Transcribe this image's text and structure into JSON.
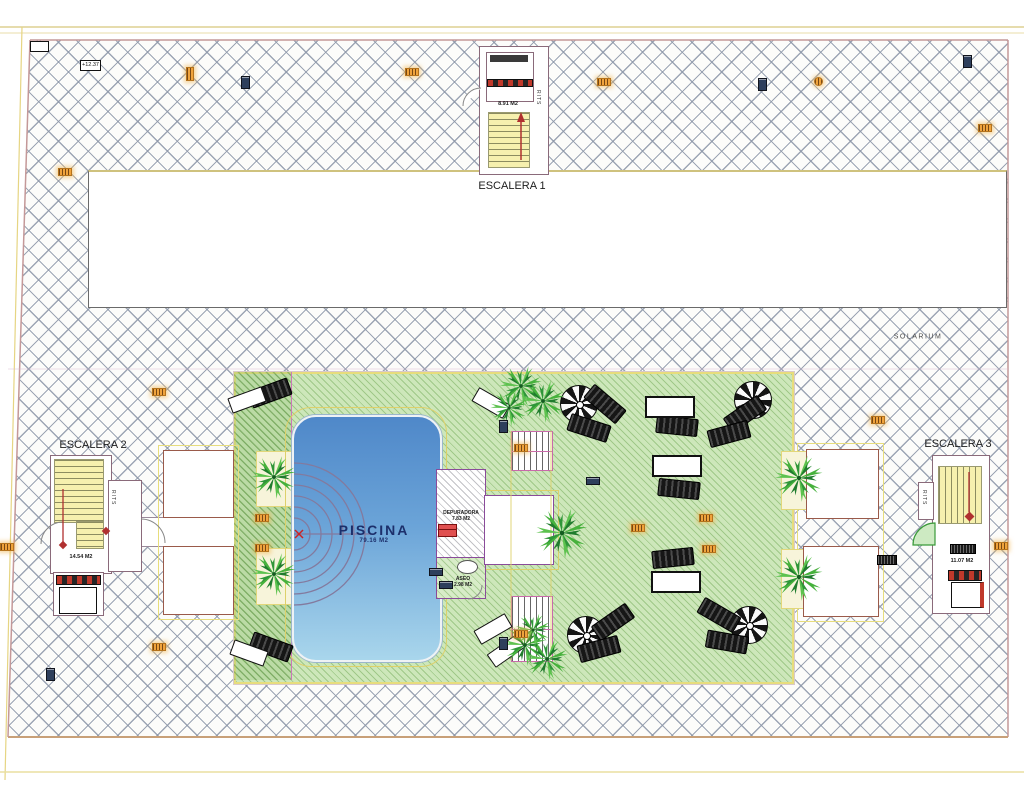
{
  "plan": {
    "stairs": [
      {
        "label": "ESCALERA 1",
        "area": "8.91 M2",
        "shaft": "RITS"
      },
      {
        "label": "ESCALERA 2",
        "area": "14.54 M2",
        "shaft": "RITS"
      },
      {
        "label": "ESCALERA 3",
        "area": "11.07 M2",
        "shaft": "RITS"
      }
    ],
    "pool": {
      "label": "PISCINA",
      "area": "79.16 M2"
    },
    "depuradora": {
      "label": "DEPURADORA",
      "area": "7.83 M2"
    },
    "aseo": {
      "label": "ASEO",
      "area": "2.98 M2"
    },
    "solarium_label": "SOLARIUM",
    "elevation_marker": "+12.37"
  },
  "colors": {
    "deck_green": "#cde7ba",
    "pool_top": "#4f88c9",
    "pool_bottom": "#a9d6ec",
    "hatch_line": "#8c96a8",
    "accent_yellow": "#e7dd7c",
    "accent_pink": "#cc79b8",
    "accent_purple": "#8a4b9a",
    "marker_orange": "#f0a33c",
    "marker_red": "#cc2222"
  }
}
